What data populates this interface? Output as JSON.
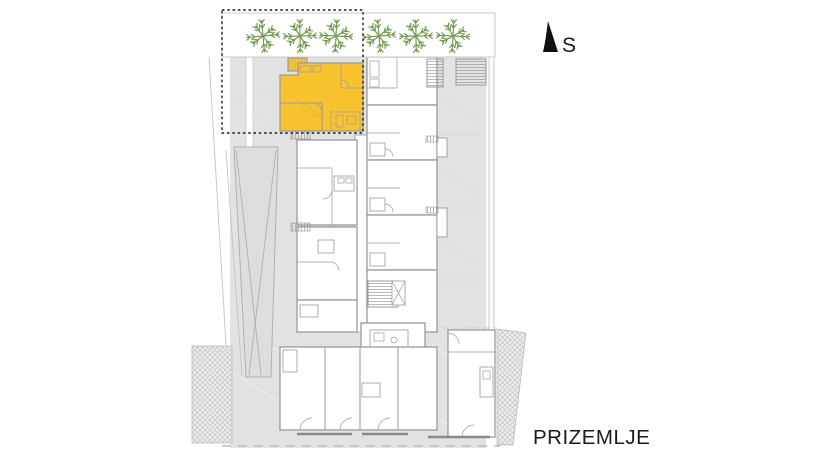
{
  "labels": {
    "floor": "PRIZEMLJE",
    "north": "S"
  },
  "colors": {
    "highlight": "#F8C231",
    "tree": "#6F9B4C",
    "site": "#E2E2E2",
    "wall": "#9A9A9A",
    "boundary": "#C9C9C9",
    "text": "#1A1A1A"
  },
  "trees": {
    "count": 6,
    "y": 36,
    "radius": 16,
    "xs": [
      263,
      300,
      336,
      379,
      416,
      453
    ]
  }
}
